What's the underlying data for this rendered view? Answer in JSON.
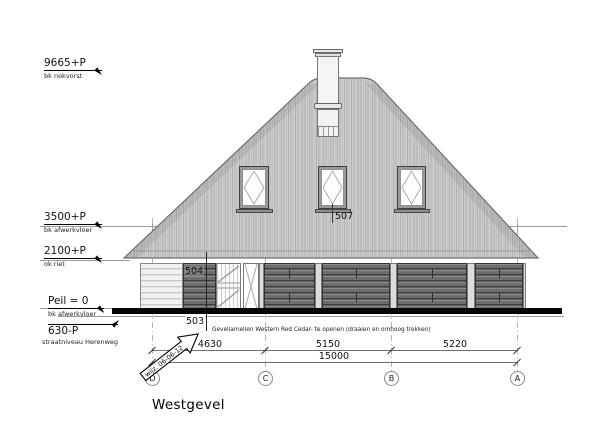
{
  "title": "Westgevel",
  "levels": [
    {
      "value": "9665+P",
      "desc": "bk nokvorst"
    },
    {
      "value": "3500+P",
      "desc": "bk afwerkvloer"
    },
    {
      "value": "2100+P",
      "desc": "ok riet"
    },
    {
      "value": "Peil = 0",
      "desc": "bk afwerkvloer"
    },
    {
      "value": "630-P",
      "desc": "straatniveau Herenweg"
    }
  ],
  "tags": {
    "roof_window": "507",
    "lamellen_upper": "504",
    "lamellen_lower": "503"
  },
  "facade_note": "Gevellamellen Western Red Cedar- te openen  (draaien en omhoog trekken)",
  "revision_note": "wijz. 06-06-12",
  "dimensions": {
    "segments": [
      "4630",
      "5150",
      "5220"
    ],
    "total": "15000"
  },
  "grid_axes": [
    "D",
    "C",
    "B",
    "A"
  ],
  "palette": {
    "roof": "#cbcbcb",
    "lamellen": "#6d6d6d",
    "ground_line": "#000000",
    "background": "#ffffff"
  }
}
